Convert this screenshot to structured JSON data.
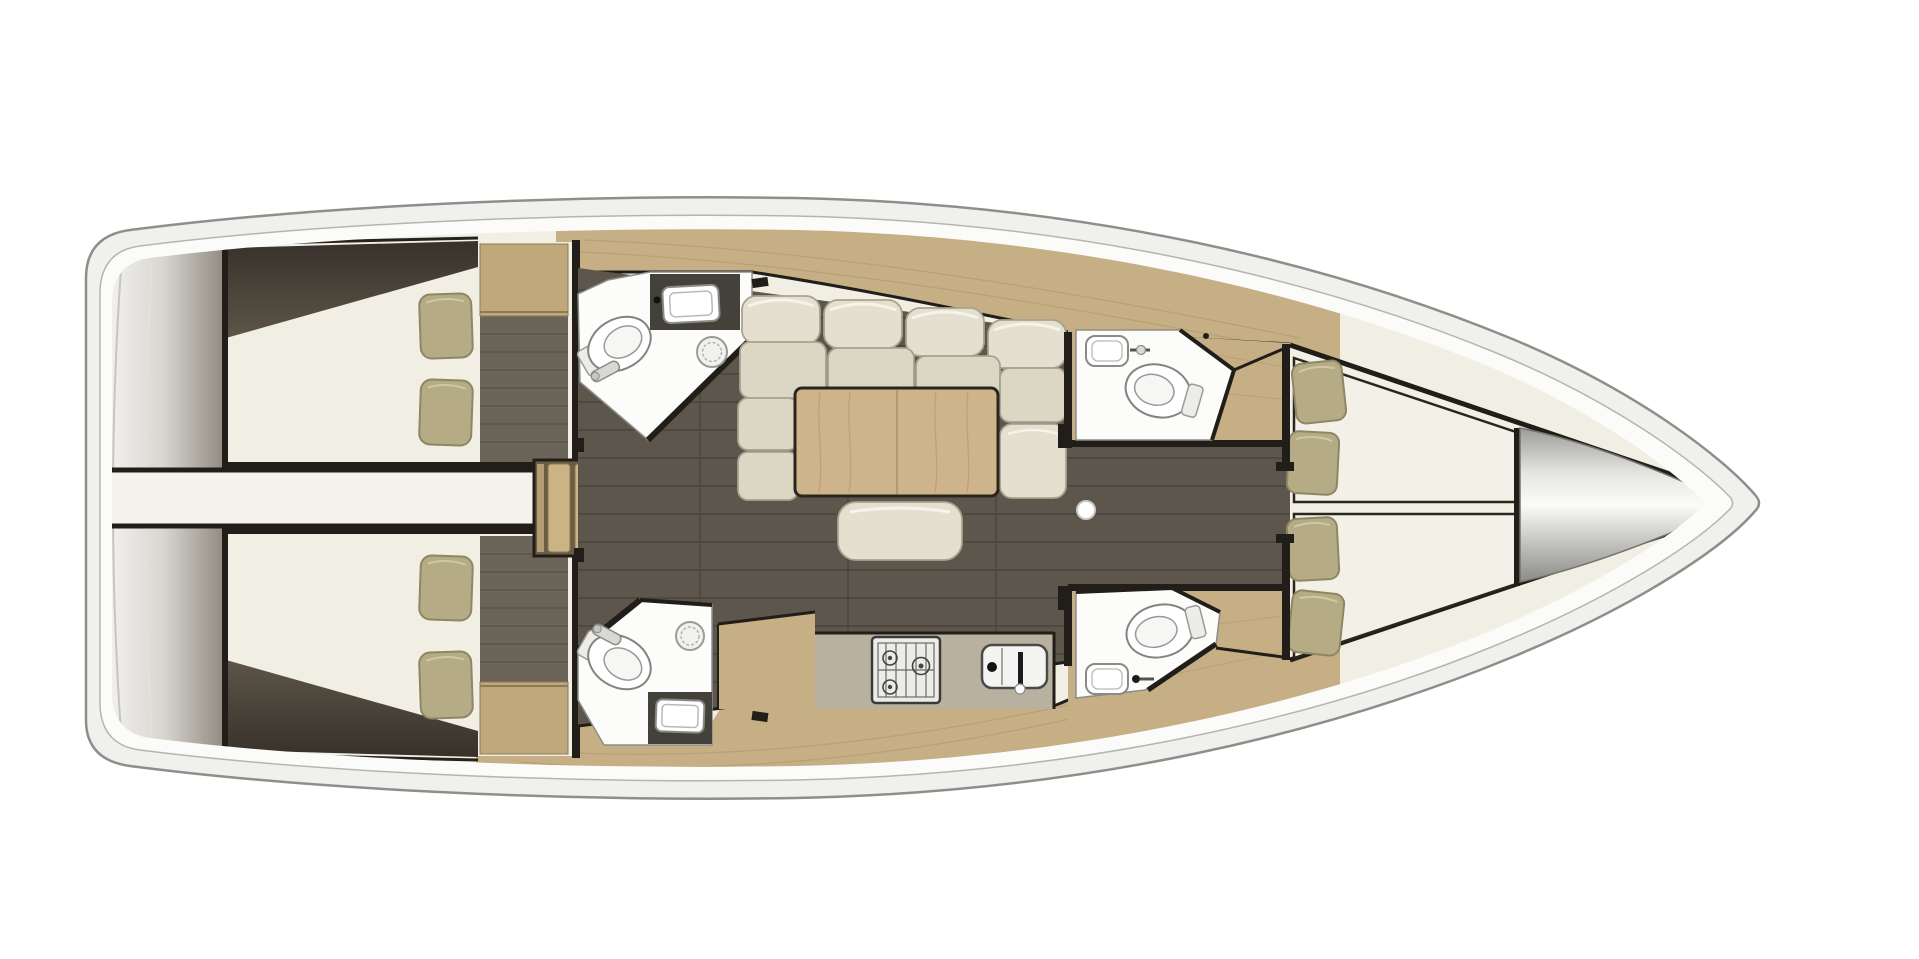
{
  "colors": {
    "background": "#ffffff",
    "hull_fill": "#f0f0ed",
    "hull_stroke": "#8e8e8a",
    "deck_ring": "#fbfbf9",
    "deck_ring_stroke": "#b5b5b0",
    "teak": "#c6ae85",
    "teak_line": "#a8905f",
    "wardrobe": "#c1a87b",
    "stair_tread": "#cbb384",
    "stair_base": "#6b5c45",
    "floor": "#5c564c",
    "floor_line": "#3e3a33",
    "cabin_floor": "#6b6459",
    "bulkhead": "#211e19",
    "bed": "#f1eee4",
    "bed_bright": "#f3f0e7",
    "pillow": "#b5ac86",
    "pillow_stroke": "#8f8666",
    "sofa": "#e4dfcf",
    "sofa_seat": "#dcd7c5",
    "sofa_stroke": "#a8a28f",
    "table": "#cdb48a",
    "table_grain": "#b1946a",
    "table_stroke": "#2a251f",
    "bath": "#fcfcfb",
    "bath_stroke": "#8d8d89",
    "counter_dark": "#44413b",
    "fixture": "#ffffff",
    "fixture_stroke": "#83837f",
    "galley_counter": "#b9b19f",
    "engine_strip": "#f4f2ec",
    "mast_dot": "#ffffff"
  },
  "floorplan": {
    "vessel": {
      "type": "sailing-yacht interior deck plan",
      "orientation": "bow-right",
      "style": "3d-render top view"
    },
    "rooms": [
      {
        "id": "stern-platform",
        "label": "stern swim platform / transom"
      },
      {
        "id": "engine-compartment",
        "label": "engine compartment strip between aft cabins"
      },
      {
        "id": "aft-cabin-port",
        "label": "aft double cabin (port, top-left)",
        "pillows": 2
      },
      {
        "id": "aft-cabin-starboard",
        "label": "aft double cabin (starboard, bottom-left)",
        "pillows": 2
      },
      {
        "id": "aft-head-port",
        "label": "aft head (top) with toilet, vanity sink, shower drain"
      },
      {
        "id": "aft-head-starboard",
        "label": "aft head (bottom) with toilet, vanity sink, shower drain"
      },
      {
        "id": "companionway-stairs",
        "label": "companionway steps",
        "treads": 4
      },
      {
        "id": "saloon",
        "label": "saloon with U-shaped settee, dining table, ottoman"
      },
      {
        "id": "galley",
        "label": "galley with 3-burner stove and sink"
      },
      {
        "id": "fwd-head-port",
        "label": "forward head (top) with toilet and sink"
      },
      {
        "id": "fwd-head-starboard",
        "label": "forward head (bottom) with toilet and sink"
      },
      {
        "id": "forward-cabin",
        "label": "forward owner cabin, V-berth split beds",
        "pillows": 4
      },
      {
        "id": "bow-locker",
        "label": "bow anchor locker cone"
      },
      {
        "id": "side-decks",
        "label": "teak side decks"
      }
    ],
    "fixture_counts": {
      "toilets": 4,
      "sinks_bath": 4,
      "shower_drains": 2,
      "stove_burners": 3,
      "galley_sinks": 1,
      "pillows_total": 8,
      "sofa_cushions": 11
    }
  }
}
